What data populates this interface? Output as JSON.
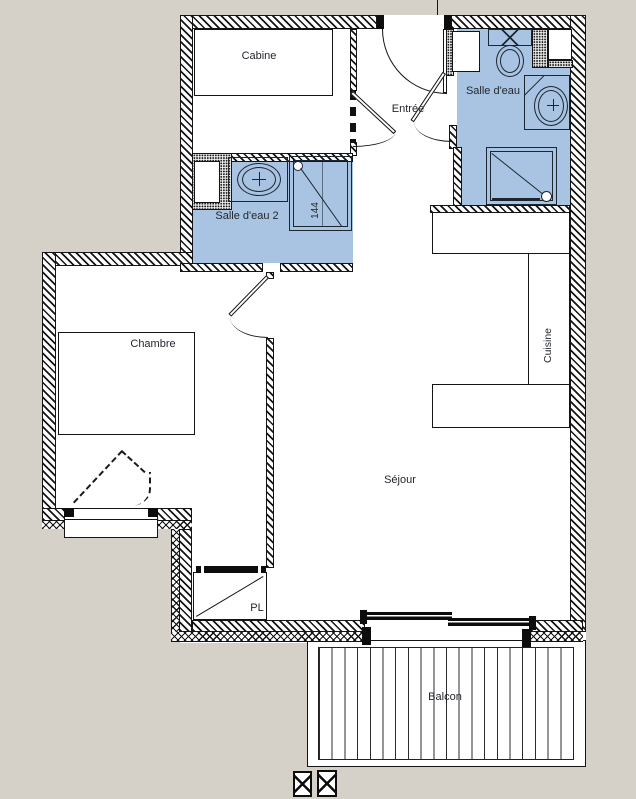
{
  "labels": {
    "cabine": "Cabine",
    "entree": "Entrée",
    "salle_deau": "Salle d'eau",
    "salle_deau_2": "Salle d'eau 2",
    "chambre": "Chambre",
    "cuisine": "Cuisine",
    "sejour": "Séjour",
    "pl": "PL",
    "balcon": "Balcon",
    "shower_dim": "144"
  },
  "colors": {
    "background": "#d5d1c8",
    "wet_room": "#a9c4e3",
    "line": "#141414",
    "fixture_line": "#1c2630",
    "floor": "#ffffff",
    "bar": "#0d0d0d"
  }
}
